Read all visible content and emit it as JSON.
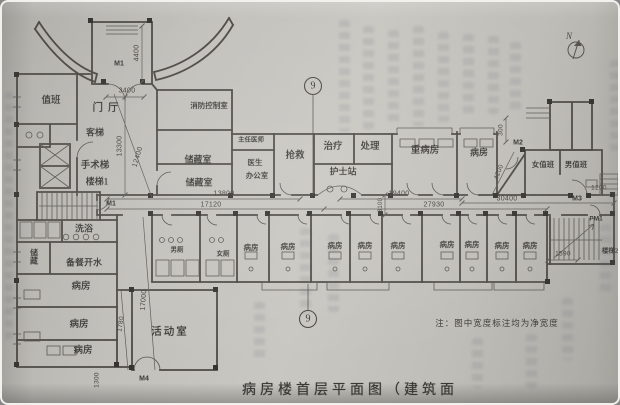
{
  "title": {
    "caption": "病房楼首层平面图（建筑面",
    "note": "注：图中宽度标注均为净宽度"
  },
  "compass": {
    "label": "N"
  },
  "axis": {
    "top_label": "9",
    "bottom_label": "9"
  },
  "doors": [
    {
      "id": "main-entrance",
      "label": "M1"
    },
    {
      "id": "west-corridor",
      "label": "M1"
    },
    {
      "id": "northeast",
      "label": "M2"
    },
    {
      "id": "east-corridor",
      "label": "M3"
    },
    {
      "id": "south-annex",
      "label": "M4"
    },
    {
      "id": "east-side",
      "label": "PM1"
    }
  ],
  "rooms": [
    {
      "label": "值班"
    },
    {
      "label": "门厅"
    },
    {
      "label": "客梯"
    },
    {
      "label": "手术梯"
    },
    {
      "label": "楼梯1"
    },
    {
      "label": "消防控制室"
    },
    {
      "label": "主任医师"
    },
    {
      "label": "储藏室"
    },
    {
      "label": "储藏室"
    },
    {
      "label": "医生"
    },
    {
      "label": "办公室"
    },
    {
      "label": "抢救"
    },
    {
      "label": "治疗"
    },
    {
      "label": "处理"
    },
    {
      "label": "护士站"
    },
    {
      "label": "重病房"
    },
    {
      "label": "病房"
    },
    {
      "label": "女值班"
    },
    {
      "label": "男值班"
    },
    {
      "label": "洗浴"
    },
    {
      "label": "储藏"
    },
    {
      "label": "备餐开水"
    },
    {
      "label": "病房"
    },
    {
      "label": "病房"
    },
    {
      "label": "病房"
    },
    {
      "label": "活动室"
    },
    {
      "label": "男厕"
    },
    {
      "label": "女厕"
    },
    {
      "label": "病房"
    },
    {
      "label": "病房"
    },
    {
      "label": "病房"
    },
    {
      "label": "病房"
    },
    {
      "label": "病房"
    },
    {
      "label": "病房"
    },
    {
      "label": "病房"
    },
    {
      "label": "病房"
    },
    {
      "label": "病房"
    },
    {
      "label": "楼梯2"
    }
  ],
  "dimensions": [
    {
      "label": "4400"
    },
    {
      "label": "3400"
    },
    {
      "label": "13300"
    },
    {
      "label": "12400"
    },
    {
      "label": "13800"
    },
    {
      "label": "17120"
    },
    {
      "label": "19400"
    },
    {
      "label": "27930"
    },
    {
      "label": "30400"
    },
    {
      "label": "3100"
    },
    {
      "label": "300"
    },
    {
      "label": "4200"
    },
    {
      "label": "1200"
    },
    {
      "label": "1590"
    },
    {
      "label": "17000"
    },
    {
      "label": "1780"
    },
    {
      "label": "1300"
    }
  ]
}
